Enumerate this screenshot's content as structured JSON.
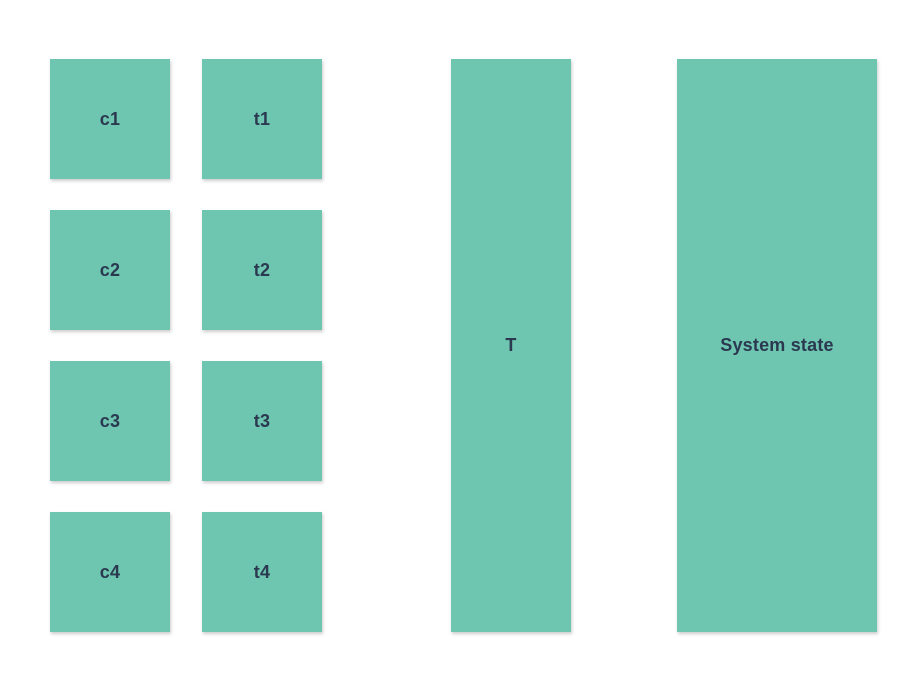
{
  "diagram": {
    "colors": {
      "box_fill": "#6ec6b1",
      "label_text": "#2b3950",
      "background": "#ffffff"
    },
    "c_blocks": [
      "c1",
      "c2",
      "c3",
      "c4"
    ],
    "t_blocks": [
      "t1",
      "t2",
      "t3",
      "t4"
    ],
    "t_bar_label": "T",
    "system_state_bar_label": "System state"
  }
}
